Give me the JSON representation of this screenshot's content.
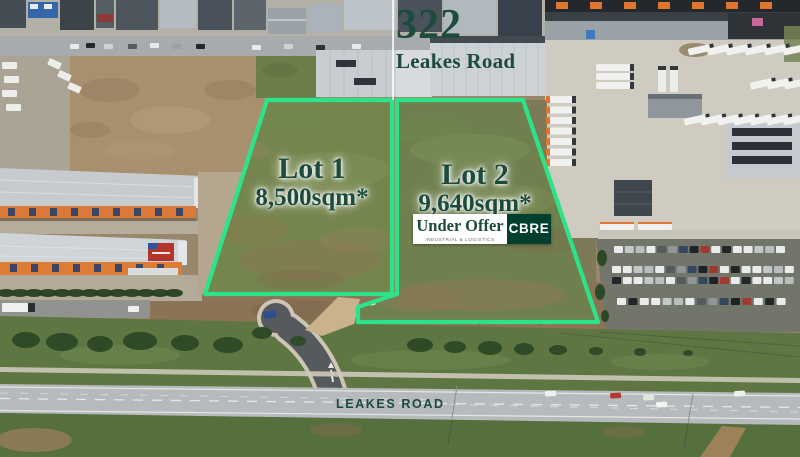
{
  "callout": {
    "street_number": "322",
    "street_name": "Leakes Road"
  },
  "lots": [
    {
      "name": "Lot 1",
      "area": "8,500sqm*"
    },
    {
      "name": "Lot 2",
      "area": "9,640sqm*",
      "status": "Under Offer",
      "status_subtext": "INDUSTRIAL & LOGISTICS"
    }
  ],
  "agency": {
    "name": "CBRE"
  },
  "road_label": "LEAKES ROAD",
  "colors": {
    "lot_outline": "#2CE389",
    "brand_green": "#003F2D",
    "headline_green": "#1C4B3D",
    "banner_bg": "#FFFFFF",
    "callout_line": "#FFFFFF"
  }
}
